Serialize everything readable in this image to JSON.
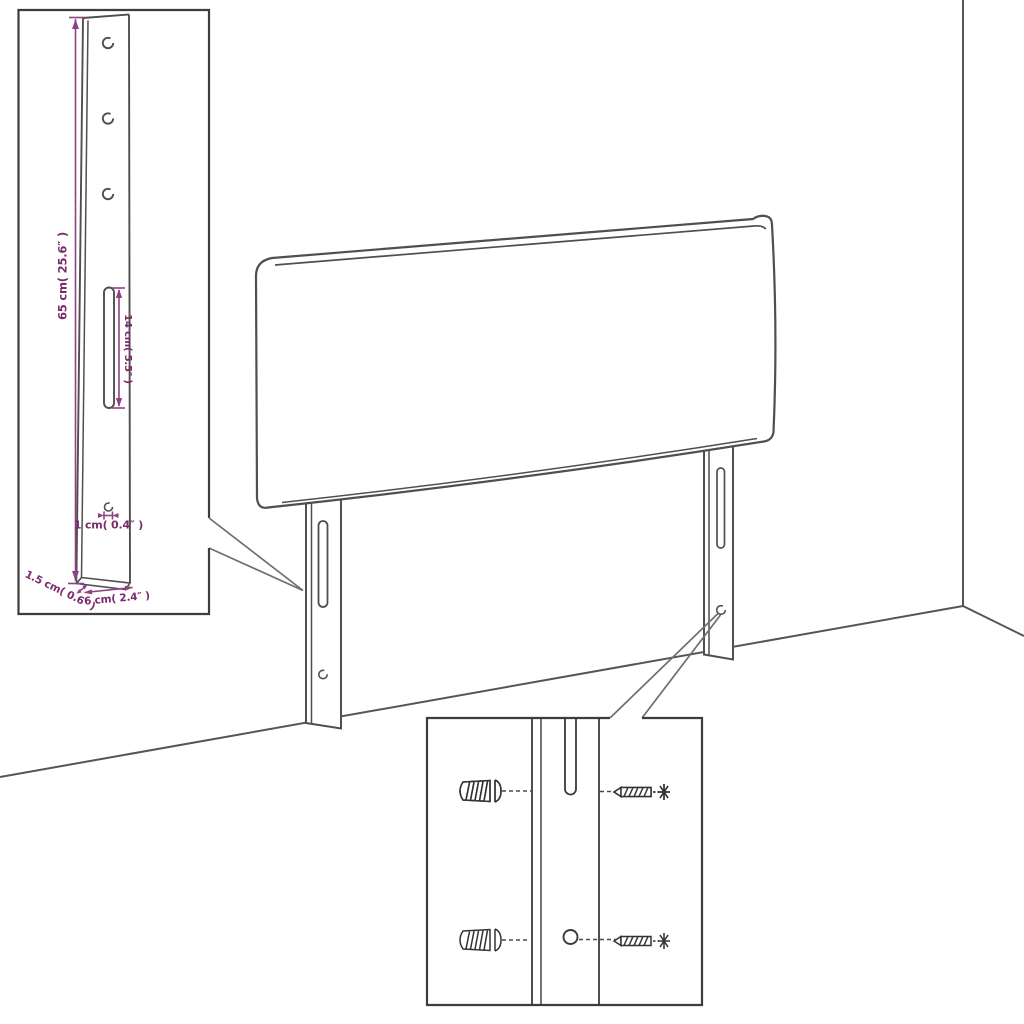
{
  "diagram": {
    "colors": {
      "outline_gray": "#4f4f4f",
      "box_border_gray": "#3d3d3d",
      "dimension_purple": "#7b2a6b"
    }
  },
  "detail_bracket": {
    "height_label": "65 cm( 25.6″ )",
    "slot_label": "14 cm( 5.5″ )",
    "hole_label": "1 cm( 0.4″ )",
    "thickness_label": "1.5 cm( 0.6″ )",
    "width_label": "6 cm( 2.4″ )"
  }
}
